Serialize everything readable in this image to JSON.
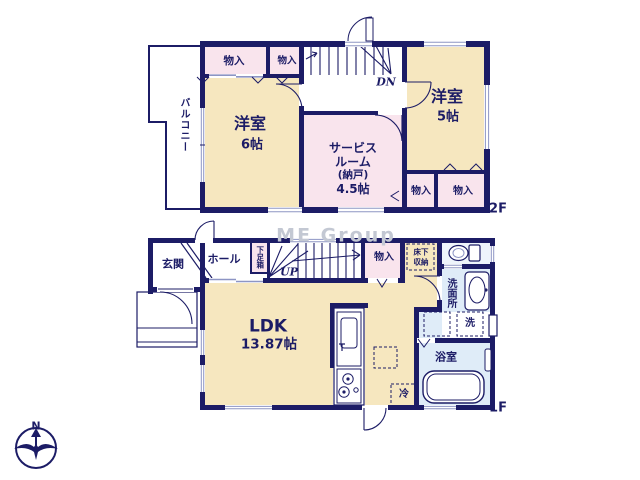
{
  "watermark": "ME Group",
  "compass": {
    "north_label": "N"
  },
  "colors": {
    "wall_navy": "#1c1c66",
    "room_cream": "#f6e7bf",
    "room_pink": "#f9e4ed",
    "room_blue": "#dfecf8",
    "window_line": "#8d95c4",
    "watermark_gray": "#c3c8d3"
  },
  "floor2": {
    "tag": "2F",
    "balcony_label": "バルコニー",
    "closet_top_left": "物入",
    "closet_top_right": "物入",
    "stairs_down_label": "DN",
    "room6_name": "洋室",
    "room6_size": "6帖",
    "service_room_line1": "サービス",
    "service_room_line2": "ルーム",
    "service_room_line3": "(納戸)",
    "service_room_line4": "4.5帖",
    "room5_name": "洋室",
    "room5_size": "5帖",
    "closet_bottom_left": "物入",
    "closet_bottom_right": "物入"
  },
  "floor1": {
    "tag": "1F",
    "entrance_label": "玄関",
    "hall_label": "ホール",
    "shoe_cabinet_label": "下足箱",
    "stairs_up_label": "UP",
    "closet_label": "物入",
    "underfloor_storage_line1": "床下",
    "underfloor_storage_line2": "収納",
    "ldk_name": "LDK",
    "ldk_size": "13.87帖",
    "washroom_label": "洗面所",
    "washer_label": "洗",
    "bathroom_label": "浴室",
    "fridge_label": "冷"
  }
}
